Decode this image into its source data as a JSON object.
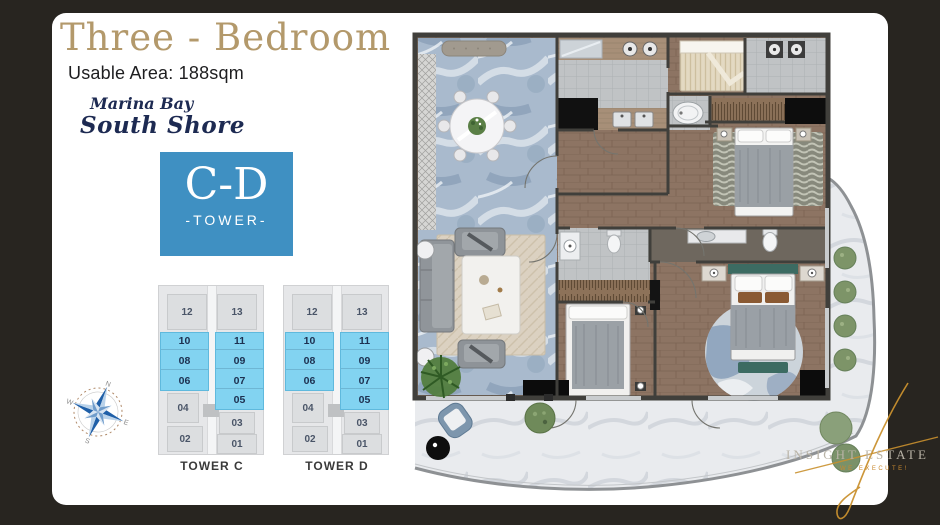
{
  "header": {
    "title": "Three - Bedroom",
    "subtitle": "Usable Area: 188sqm"
  },
  "brand": {
    "line1": "Marina Bay",
    "line2": "South Shore"
  },
  "badge": {
    "name": "C-D",
    "label": "-TOWER-"
  },
  "towers": [
    {
      "label": "TOWER C",
      "top": [
        "12",
        "13"
      ],
      "left_stack": [
        "10",
        "08",
        "06"
      ],
      "right_stack": [
        "11",
        "09",
        "07",
        "05"
      ],
      "mid": [
        "04",
        "03"
      ],
      "bottom": [
        "02",
        "01"
      ]
    },
    {
      "label": "TOWER D",
      "top": [
        "12",
        "13"
      ],
      "left_stack": [
        "10",
        "08",
        "06"
      ],
      "right_stack": [
        "11",
        "09",
        "07",
        "05"
      ],
      "mid": [
        "04",
        "03"
      ],
      "bottom": [
        "02",
        "01"
      ]
    }
  ],
  "compass": {
    "n": "N",
    "e": "E",
    "s": "S",
    "w": "W"
  },
  "watermark": {
    "name": "INSIGHT ESTATE",
    "tagline": "WE EXECUTE!"
  },
  "colors": {
    "frame": "#282520",
    "card": "#ffffff",
    "title_gold": "#b3996b",
    "brand_navy": "#1d2a52",
    "badge_blue": "#3f90c2",
    "highlight_blue": "#82d3f1",
    "marble_blue": "#a9bacd",
    "wood": "#8d7463",
    "watermark_gold": "#c8892f"
  }
}
